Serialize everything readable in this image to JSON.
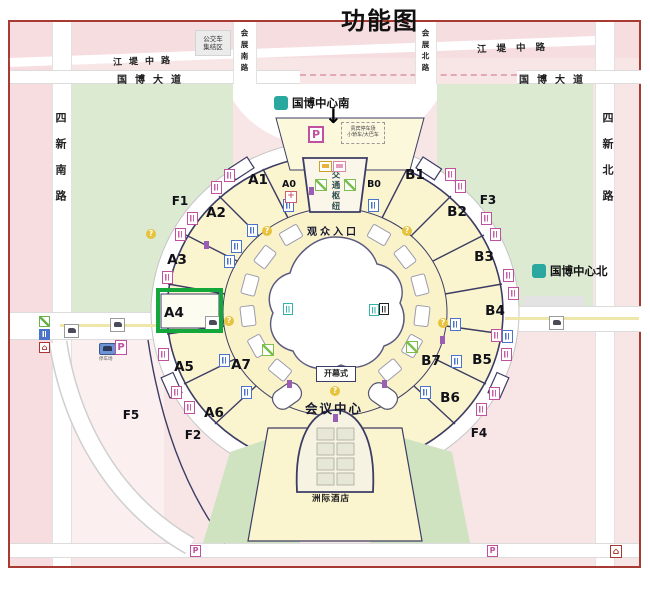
{
  "title": "功能图",
  "roads": {
    "sixin_south": "四新南路",
    "sixin_north": "四新北路",
    "jiangdi": "江堤中路",
    "guobo_avenue": "国博大道",
    "huizhan_south": "会展南路",
    "huizhan_north": "会展北路"
  },
  "stations": {
    "south": "国博中心南",
    "north": "国博中心北"
  },
  "places": {
    "bus_area_line1": "公交车",
    "bus_area_line2": "集结区",
    "vip_parking_line1": "贵宾停车场",
    "vip_parking_line2": "小轿车/大巴车",
    "west_parking": "停车场",
    "transport_hub": "交通枢纽",
    "audience_entrance": "观众入口",
    "opening_ceremony": "开幕式",
    "conference_center": "会议中心",
    "hotel": "洲际酒店"
  },
  "halls": {
    "a0": "A0",
    "a1": "A1",
    "a2": "A2",
    "a3": "A3",
    "a4": "A4",
    "a5": "A5",
    "a6": "A6",
    "a7": "A7",
    "b0": "B0",
    "b1": "B1",
    "b2": "B2",
    "b3": "B3",
    "b4": "B4",
    "b5": "B5",
    "b6": "B6",
    "b7": "B7",
    "f1": "F1",
    "f2": "F2",
    "f3": "F3",
    "f4": "F4",
    "f5": "F5"
  },
  "highlight": {
    "hall": "A4",
    "box_color": "#14a83c"
  },
  "symbols": {
    "parking": "P",
    "down_arrow": "↓",
    "home": "⌂",
    "question": "?",
    "cross": "+"
  },
  "colors": {
    "map_pink": "#f8e6e7",
    "grass_green": "#dcead2",
    "hall_yellow": "#fbf5cf",
    "outline_navy": "#3c3c64",
    "metro_teal": "#2aa79e",
    "icon_magenta": "#c0519f",
    "border_red": "#a83a34",
    "highlight_green": "#14a83c"
  }
}
